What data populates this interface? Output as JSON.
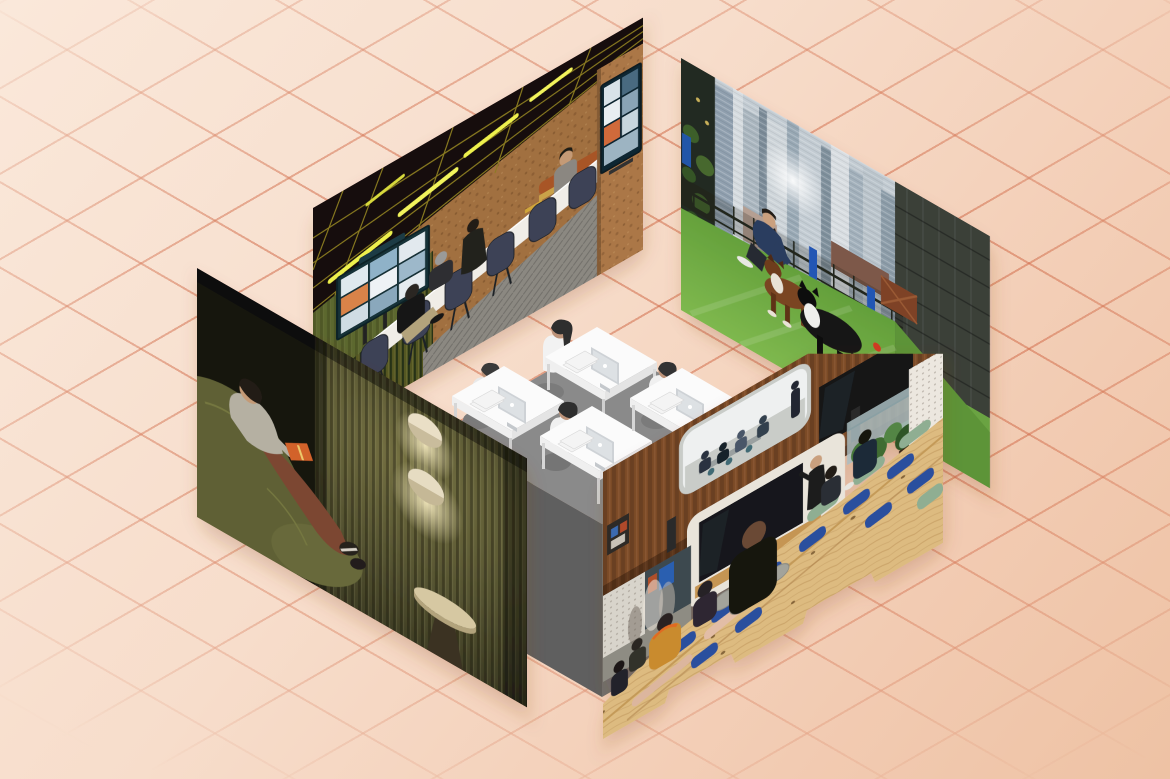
{
  "scene": {
    "description": "Editorial collage: four office-lifestyle photographs skewed onto isometric planes form an open box around a grayscale isometric illustration of four people working at computer desks, all on a peach background with a fading diagonal diamond grid.",
    "canvas": {
      "width": 1170,
      "height": 779
    }
  },
  "background": {
    "top_left_color": "#fae8da",
    "bottom_right_color": "#eec2a4",
    "grid": {
      "line_color": "#d26e4c",
      "diamond_width_px": 148,
      "diamond_height_px": 85,
      "line_angle_deg": 30
    }
  },
  "photos": [
    {
      "id": "meeting-room",
      "caption": "Hybrid team meeting: people around a long white table with navy task chairs in a cork-walled room, black ceiling with brass grid and glowing strip lights, green ribbed wall with a video-call screen showing a grid of remote participants, and a second video-call display on a cork pillar",
      "key_colors": [
        "#17110a",
        "#8c7c22",
        "#eef04e",
        "#a1703f",
        "#5c672f",
        "#123038",
        "#3d4356",
        "#f0ede7",
        "#8b8881",
        "#a85528"
      ]
    },
    {
      "id": "rooftop-dog-terrace",
      "caption": "Bearded man in a navy jacket crouching to play with a brown dog and a black-and-white dog on artificial turf of a rooftop dog park, black mesh fence with blue posts, dense city skyscrapers behind and a dark glass tower at right",
      "key_colors": [
        "#c2cbd2",
        "#3a3f39",
        "#23261f",
        "#2456b4",
        "#6aa63e",
        "#2c3e5e",
        "#7a4423",
        "#141414"
      ]
    },
    {
      "id": "reading-lounge",
      "caption": "Person reclining on an olive-green sofa reading an orange book in a dark quiet room with a vertically ribbed timber wall, two glowing disc wall sconces and a small round pedestal table",
      "key_colors": [
        "#15160f",
        "#5f6134",
        "#b5b0a2",
        "#7c4630",
        "#d2622c",
        "#eadfc6",
        "#d6c8a2"
      ]
    },
    {
      "id": "amphitheater",
      "caption": "All-hands on tiered blond-wood amphitheater steps with blue and green cushions and felt poufs; audience watches a presenter beside a large screen under a walnut-clad wall with a rounded meeting-room window, glass balustrade and plants at right",
      "key_colors": [
        "#7c4b28",
        "#dde4e6",
        "#121417",
        "#e9e4da",
        "#ddbb80",
        "#2b4f9e",
        "#8fae92",
        "#a3a39b",
        "#c98b2e",
        "#17130f"
      ]
    }
  ],
  "panel_edge": {
    "id": "ribbed-gold-edge",
    "caption": "Ribbed dark-olive and brass edge band running along the top of the reading-lounge panel",
    "key_colors": [
      "#2e2d18",
      "#8a7a2e",
      "#d8c050"
    ]
  },
  "illustration": {
    "id": "isometric-workstations",
    "caption": "Grayscale isometric illustration of four workers with black hair and white tops at white desks with monitors and keyboards on a gray raised platform",
    "workstations": 4,
    "key_colors": [
      "#8a8a8a",
      "#5f5f5f",
      "#fbfbfb",
      "#cdd1d5",
      "#bd9379",
      "#2e2e2e"
    ]
  }
}
